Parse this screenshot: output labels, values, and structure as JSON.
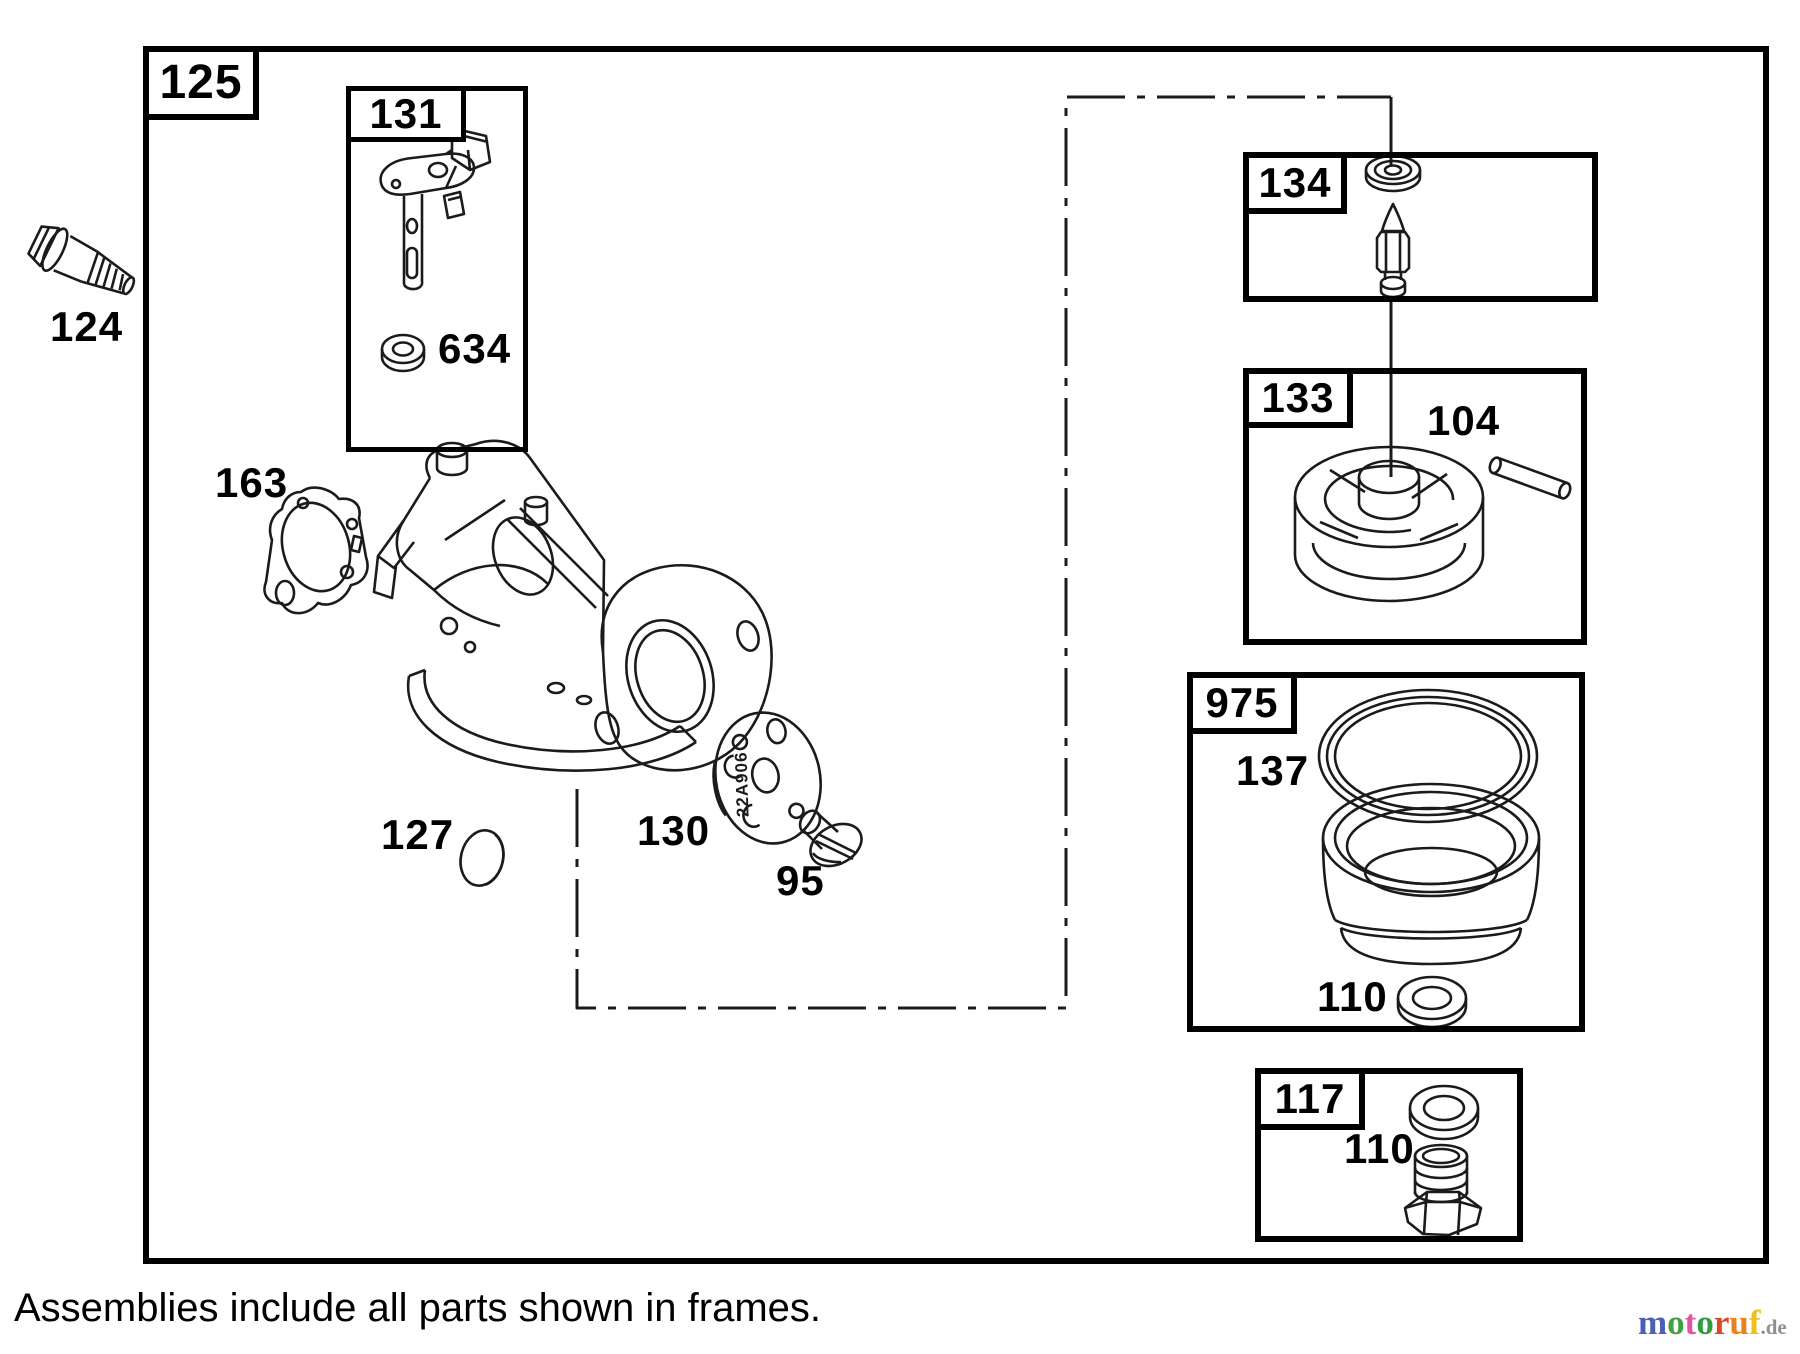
{
  "note": "Assemblies include all parts shown in frames.",
  "frames": {
    "f125": "125",
    "f131": "131",
    "f134": "134",
    "f133": "133",
    "f975": "975",
    "f117": "117"
  },
  "parts": {
    "p124": "124",
    "p634": "634",
    "p163": "163",
    "p127": "127",
    "p130": "130",
    "p95": "95",
    "p104": "104",
    "p137": "137",
    "p110_bowl": "110",
    "p110_drain": "110"
  },
  "stamp": "22A906",
  "colors": {
    "line": "#1b1b1b",
    "frame_border": "#000000",
    "background": "#ffffff",
    "logo_suffix": "#8f8f8f"
  },
  "watermark": {
    "letters": [
      {
        "ch": "m",
        "style": "color:#4a5fb8"
      },
      {
        "ch": "o",
        "style": "color:#3fa23f"
      },
      {
        "ch": "t",
        "style": "color:#e0559d"
      },
      {
        "ch": "o",
        "style": "color:#2f9e43"
      },
      {
        "ch": "r",
        "style": "color:#d94b26"
      },
      {
        "ch": "u",
        "style": "color:#e8821f"
      },
      {
        "ch": "f",
        "style": "color:#eec01f"
      }
    ],
    "suffix": ".de"
  }
}
